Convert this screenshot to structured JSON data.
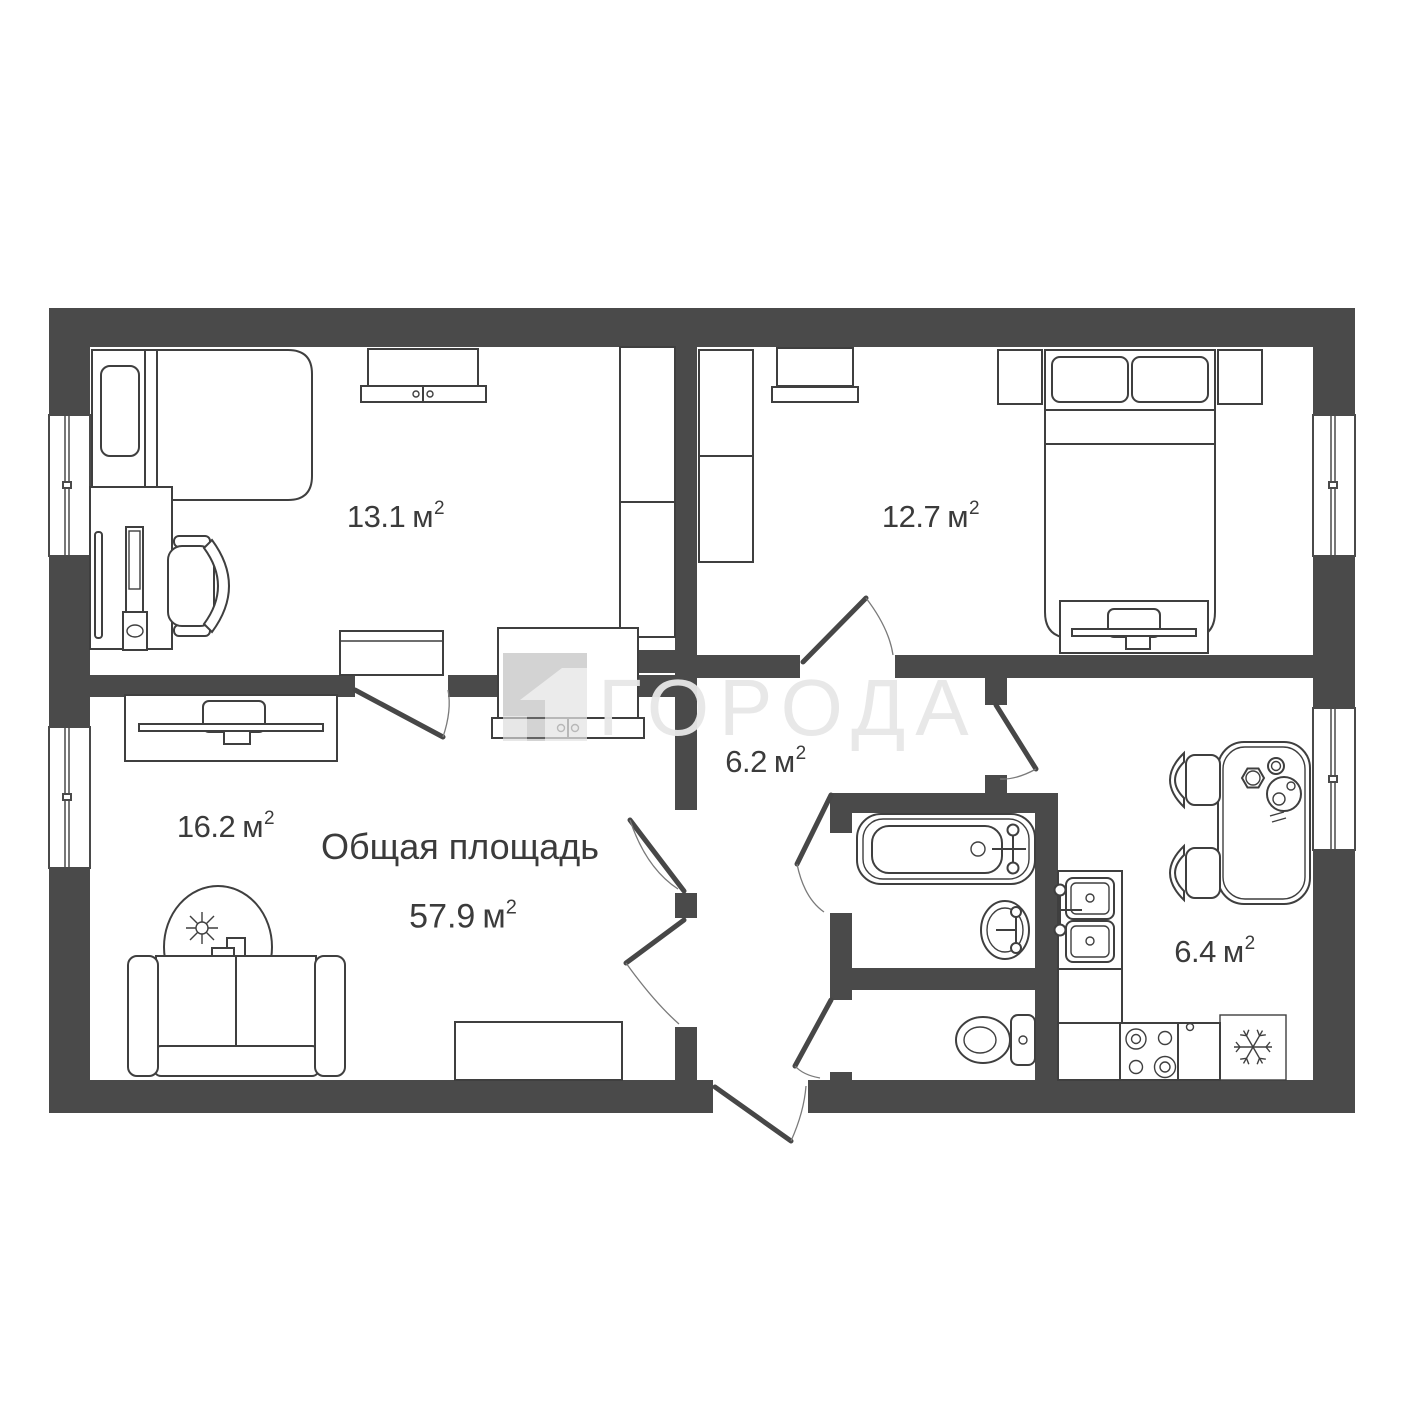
{
  "watermark": {
    "text": "ГОРОДА",
    "logo": "goroda-city-block-logo"
  },
  "summary": {
    "label": "Общая площадь",
    "value": "57.9",
    "unit": "м",
    "sup": "2"
  },
  "rooms": [
    {
      "id": "bedroom-top-left",
      "area": "13.1",
      "unit": "м",
      "sup": "2"
    },
    {
      "id": "bedroom-top-right",
      "area": "12.7",
      "unit": "м",
      "sup": "2"
    },
    {
      "id": "living-room",
      "area": "16.2",
      "unit": "м",
      "sup": "2"
    },
    {
      "id": "hallway",
      "area": "6.2",
      "unit": "м",
      "sup": "2"
    },
    {
      "id": "kitchen",
      "area": "6.4",
      "unit": "м",
      "sup": "2"
    }
  ],
  "colors": {
    "wall": "#4a4a4a",
    "line": "#3f3f3f",
    "label_text": "#3b3b3b",
    "watermark": "#e7e7e7"
  },
  "furniture": {
    "bedroom_top_left": [
      "single-bed",
      "pillow",
      "wall-shelf",
      "wardrobe",
      "desk",
      "computer-monitor",
      "mouse-pad",
      "office-chair",
      "dresser"
    ],
    "bedroom_top_right": [
      "wardrobe",
      "wall-shelf",
      "nightstand",
      "double-bed",
      "pillows",
      "nightstand",
      "tv-stand"
    ],
    "living_room": [
      "tv-stand",
      "built-in-closet",
      "decor-plant",
      "sofa",
      "cabinet"
    ],
    "bathroom": [
      "bathtub",
      "washbasin"
    ],
    "toilet_room": [
      "toilet"
    ],
    "kitchen": [
      "dining-table",
      "tableware",
      "chair",
      "chair",
      "double-sink",
      "counter",
      "stove",
      "fridge"
    ]
  }
}
